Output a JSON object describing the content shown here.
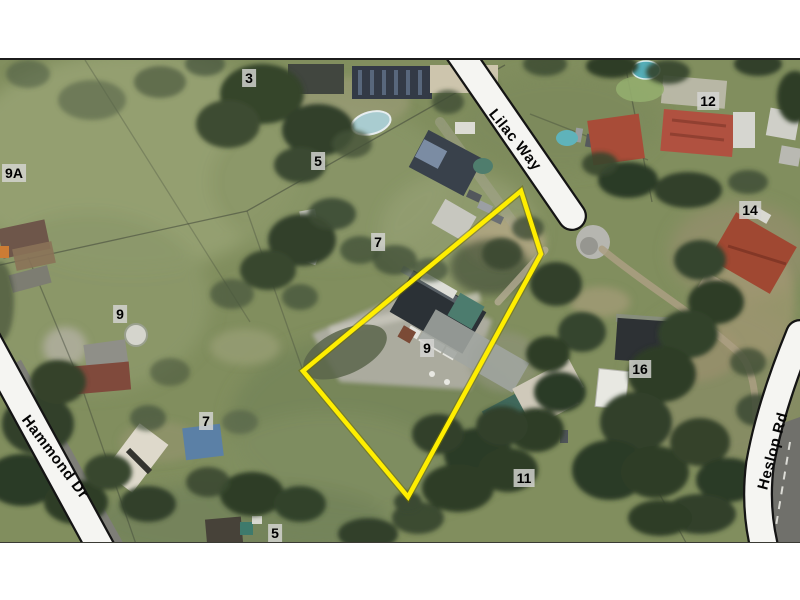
{
  "map": {
    "type": "aerial-parcel-map",
    "streets": [
      "Lilac Way",
      "Hammond Dr",
      "Heslop Rd"
    ],
    "lots": [
      "3",
      "5",
      "7",
      "9A",
      "9",
      "7",
      "9",
      "5",
      "11",
      "12",
      "14",
      "16"
    ],
    "parcel": {
      "lot": "9",
      "points": "521,189 541,252 408,495 303,369",
      "color": "#ffee00"
    },
    "colors": {
      "parcel_highlight": "#ffee00",
      "road_band_fill": "#f5f5f2",
      "road_band_outline": "#141414",
      "label_background": "#d5d5d3",
      "label_text": "#000000",
      "margin": "#ffffff"
    }
  }
}
